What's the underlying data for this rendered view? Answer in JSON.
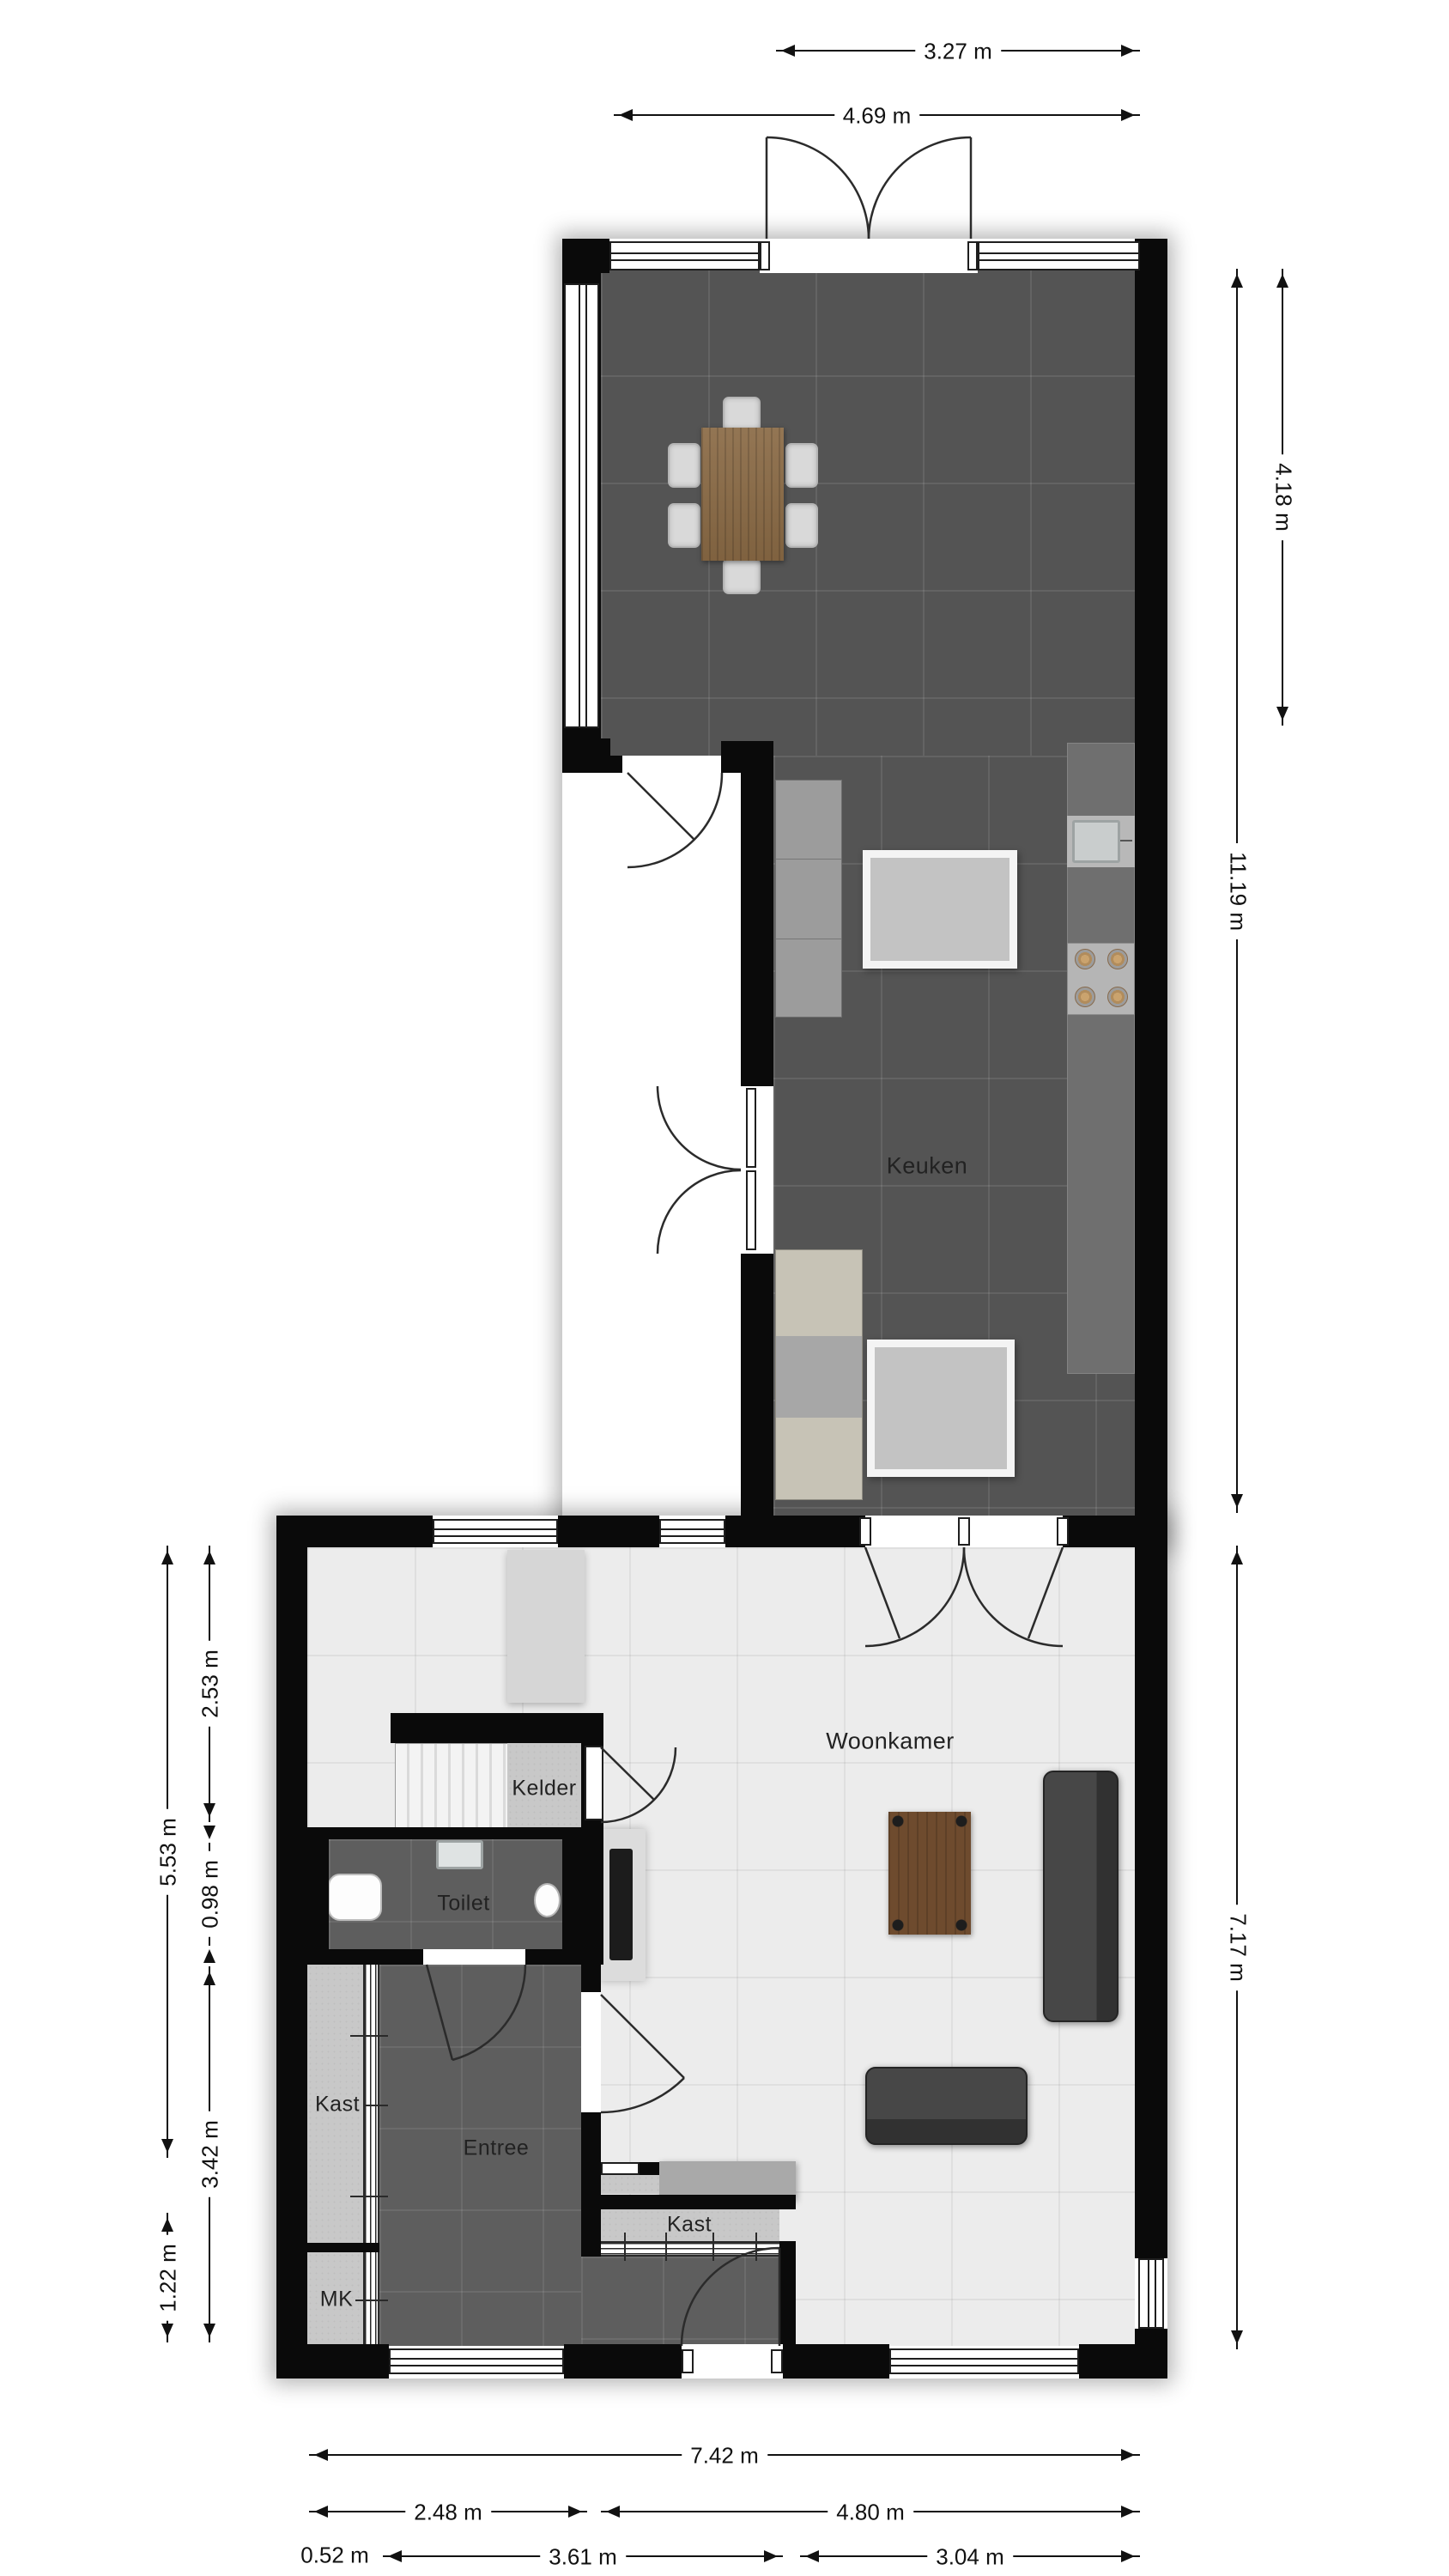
{
  "rooms": {
    "keuken": "Keuken",
    "woonkamer": "Woonkamer",
    "kelder": "Kelder",
    "toilet": "Toilet",
    "kast_hal": "Kast",
    "kast_woonkamer": "Kast",
    "entree": "Entree",
    "mk": "MK"
  },
  "dimensions": {
    "top": {
      "w327": "3.27 m",
      "w469": "4.69 m"
    },
    "right": {
      "h418": "4.18 m",
      "h1119": "11.19 m",
      "h717": "7.17 m"
    },
    "left": {
      "h553": "5.53 m",
      "h253": "2.53 m",
      "h098": "0.98 m",
      "h342": "3.42 m",
      "h122": "1.22 m"
    },
    "bottom": {
      "w742": "7.42 m",
      "w248": "2.48 m",
      "w480": "4.80 m",
      "w052": "0.52 m",
      "w361": "3.61 m",
      "w304": "3.04 m"
    }
  },
  "colors": {
    "wall": "#0a0a0a",
    "kitchen_floor": "#545454",
    "living_floor": "#ececec",
    "hall_floor": "#5e5e5e",
    "closet_floor": "#c8c8c8",
    "dining_table_wood": "#8a6a45",
    "coffee_table_wood": "#6e4b2e",
    "sofa": "#404040",
    "island": "#c3c3c3"
  }
}
